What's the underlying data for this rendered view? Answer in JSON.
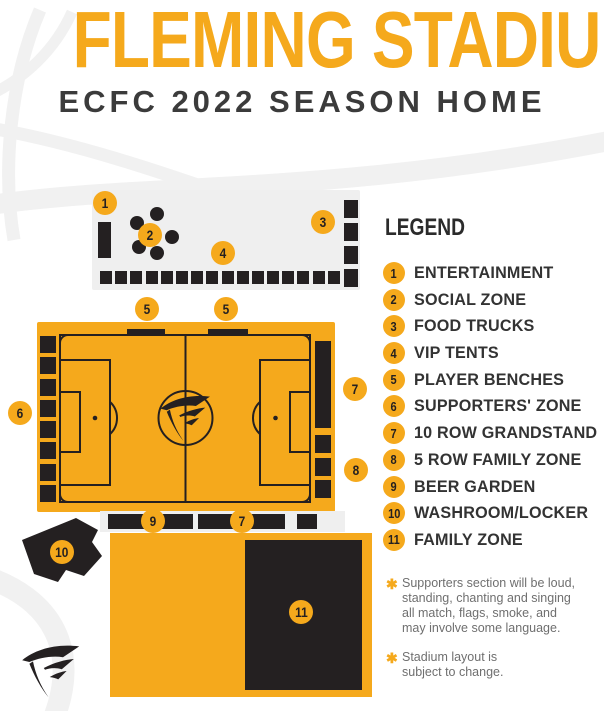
{
  "header": {
    "title": "FLEMING STADIUM",
    "subtitle": "ECFC 2022 SEASON HOME"
  },
  "legend": {
    "heading": "LEGEND",
    "items": [
      {
        "num": "1",
        "label": "ENTERTAINMENT"
      },
      {
        "num": "2",
        "label": "SOCIAL ZONE"
      },
      {
        "num": "3",
        "label": "FOOD TRUCKS"
      },
      {
        "num": "4",
        "label": "VIP TENTS"
      },
      {
        "num": "5",
        "label": "PLAYER BENCHES"
      },
      {
        "num": "6",
        "label": "SUPPORTERS' ZONE"
      },
      {
        "num": "7",
        "label": "10 ROW GRANDSTAND"
      },
      {
        "num": "8",
        "label": "5 ROW FAMILY ZONE"
      },
      {
        "num": "9",
        "label": "BEER GARDEN"
      },
      {
        "num": "10",
        "label": "WASHROOM/LOCKER"
      },
      {
        "num": "11",
        "label": "FAMILY ZONE"
      }
    ]
  },
  "map": {
    "badges": [
      {
        "num": "1"
      },
      {
        "num": "2"
      },
      {
        "num": "3"
      },
      {
        "num": "4"
      },
      {
        "num": "5"
      },
      {
        "num": "5"
      },
      {
        "num": "6"
      },
      {
        "num": "7"
      },
      {
        "num": "8"
      },
      {
        "num": "9"
      },
      {
        "num": "7"
      },
      {
        "num": "10"
      },
      {
        "num": "11"
      }
    ]
  },
  "notes": [
    {
      "marker": "✱",
      "text": "Supporters section will be loud,\nstanding, chanting and singing\nall match, flags, smoke, and\nmay involve some language."
    },
    {
      "marker": "✱",
      "text": "Stadium layout is\nsubject to change."
    }
  ],
  "colors": {
    "gold": "#F5A91C",
    "dark": "#242021",
    "zone_gray": "#EFEFEF",
    "road_gray": "#F1F1F1",
    "note_text": "#6F6F6F"
  }
}
